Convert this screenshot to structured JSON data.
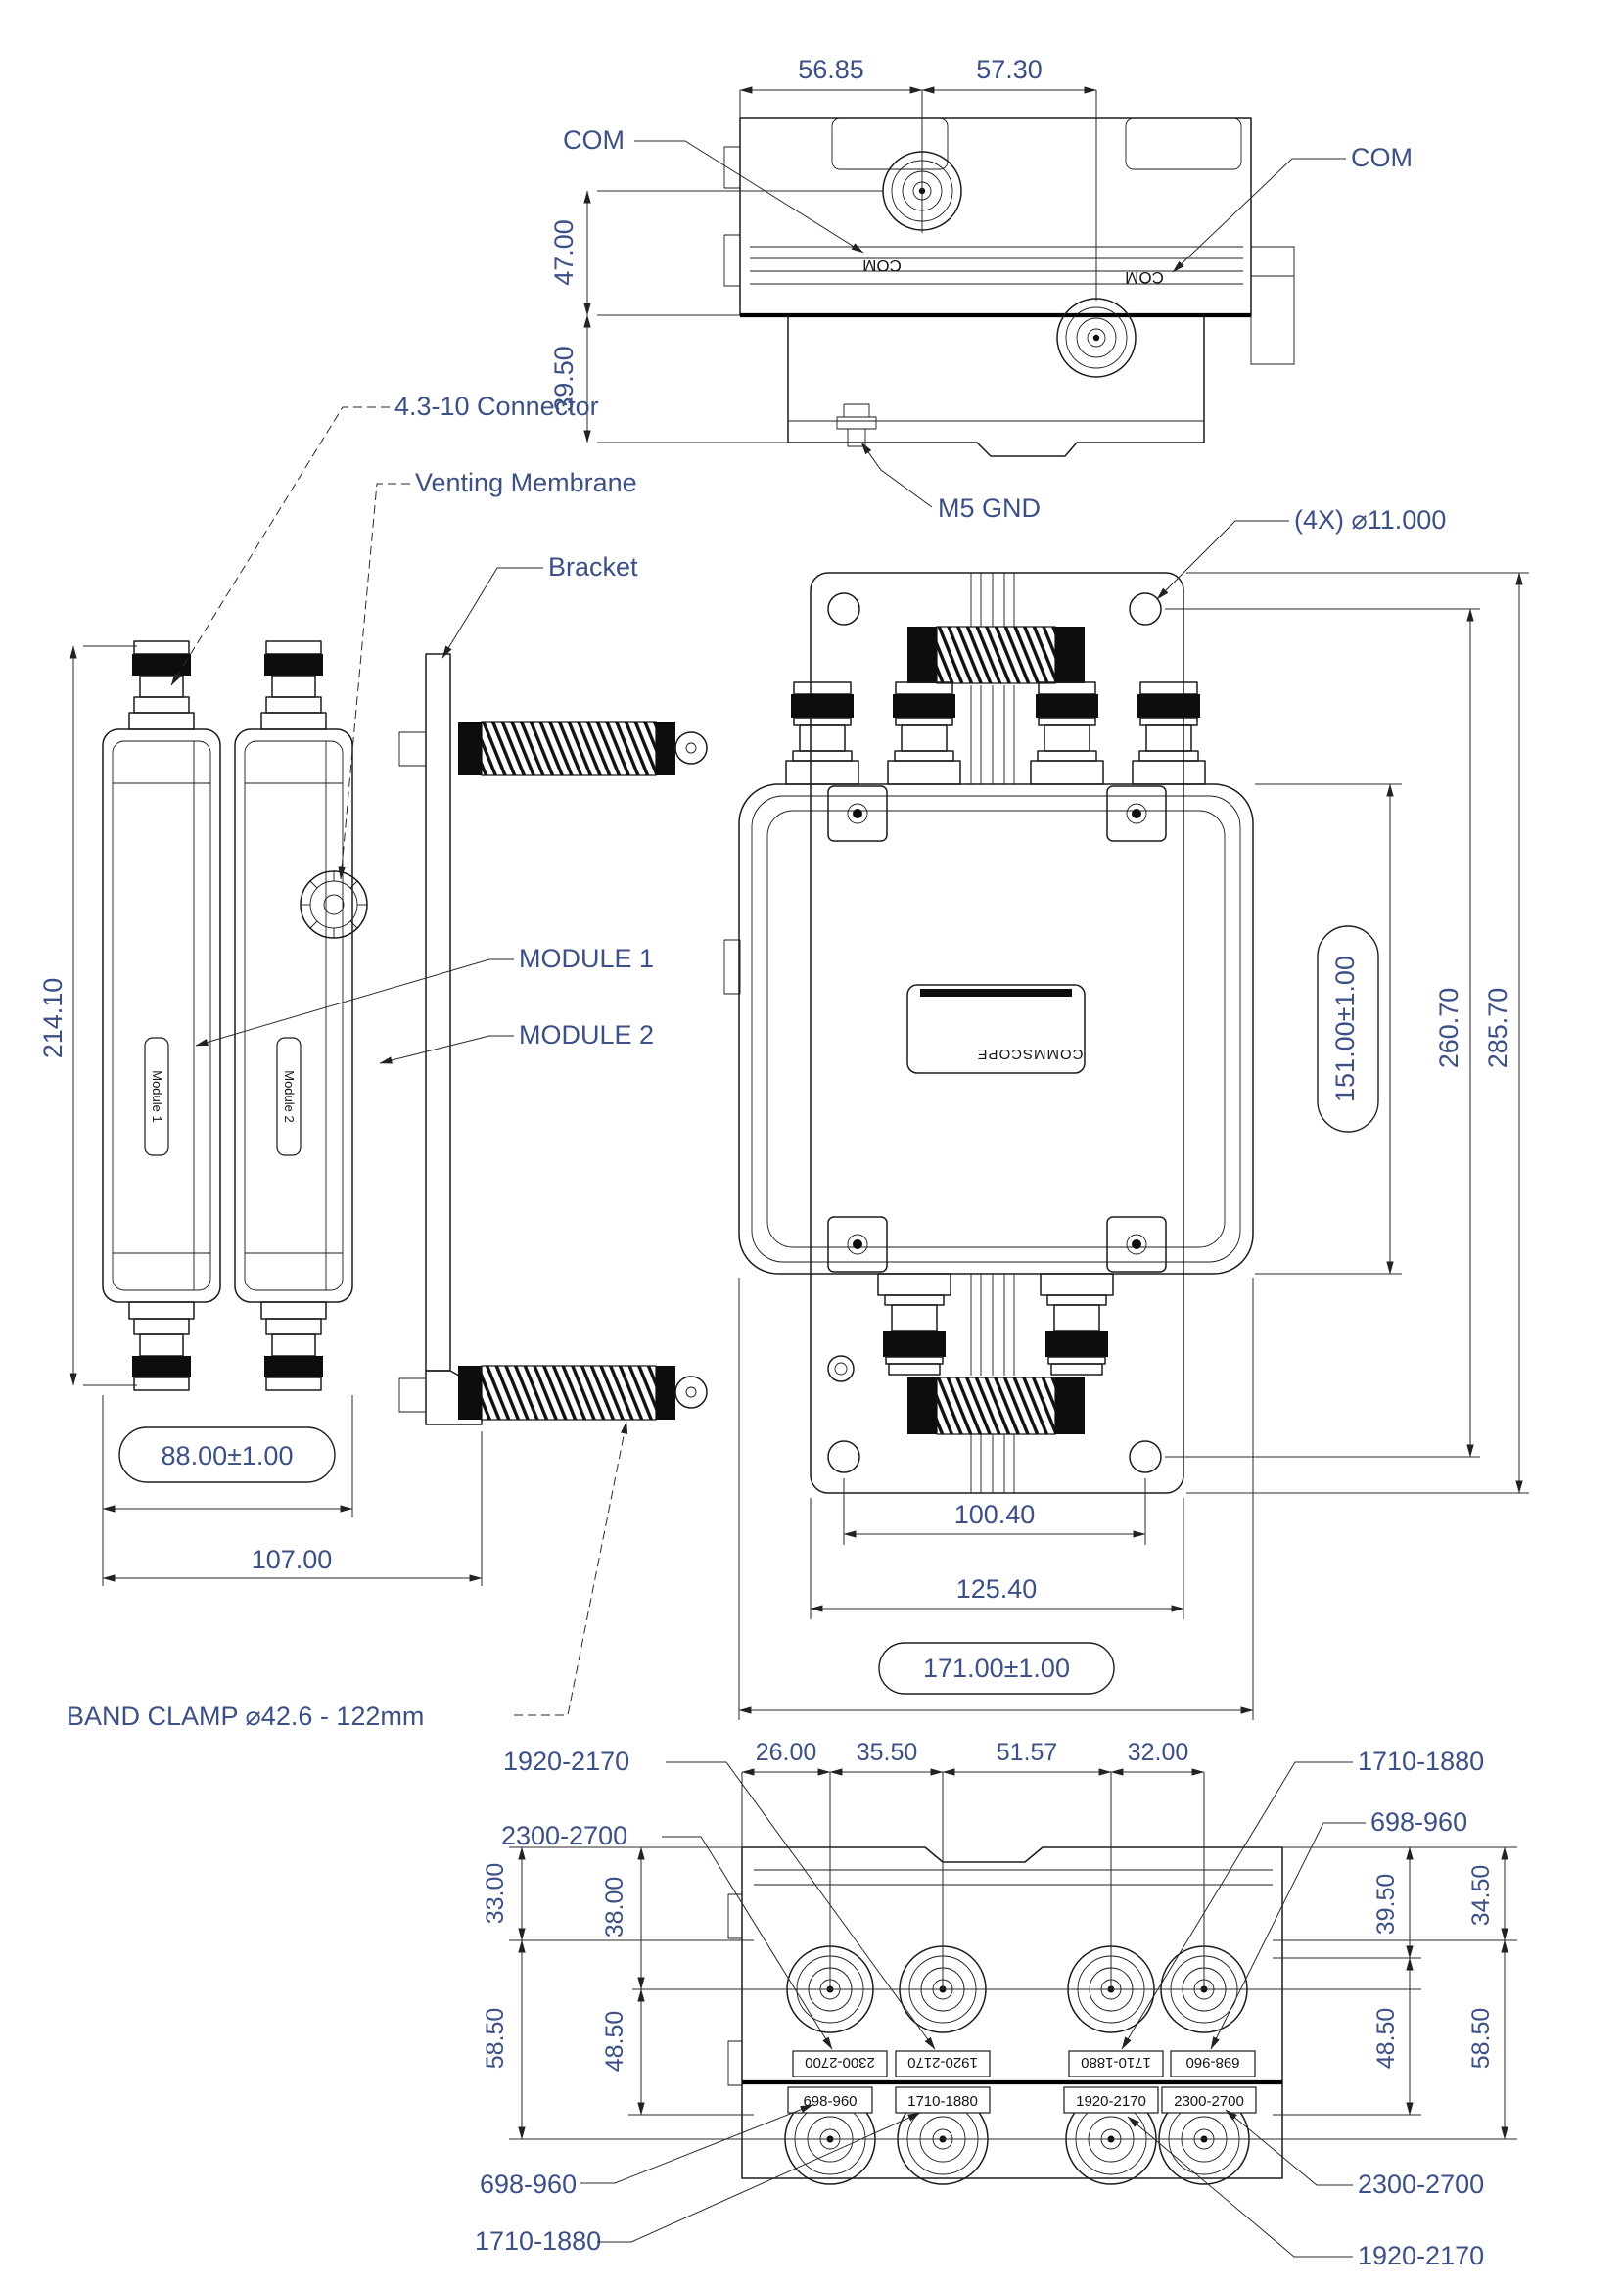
{
  "drawing": {
    "colors": {
      "background": "#ffffff",
      "line": "#1b1b1b",
      "dimension_text": "#3c5086"
    }
  },
  "views": {
    "top": {
      "dim_56_85": "56.85",
      "dim_57_30": "57.30",
      "dim_47_00": "47.00",
      "dim_39_50": "39.50",
      "callout_com_left": "COM",
      "callout_com_right": "COM",
      "callout_m5_gnd": "M5 GND",
      "marking_com_left": "COM",
      "marking_com_right": "COM"
    },
    "side": {
      "dim_214_10": "214.10",
      "dim_88_00": "88.00±1.00",
      "dim_107_00": "107.00",
      "callout_connector": "4.3-10 Connector",
      "callout_venting": "Venting Membrane",
      "callout_bracket": "Bracket",
      "callout_module1": "MODULE 1",
      "callout_module2": "MODULE 2",
      "callout_band_clamp": "BAND CLAMP ⌀42.6 - 122mm",
      "marking_module1": "Module 1",
      "marking_module2": "Module 2"
    },
    "front": {
      "callout_holes": "(4X) ⌀11.000",
      "dim_151_00": "151.00±1.00",
      "dim_260_70": "260.70",
      "dim_285_70": "285.70",
      "dim_100_40": "100.40",
      "dim_125_40": "125.40",
      "dim_171_00": "171.00±1.00",
      "marking_brand": "COMMSCOPE"
    },
    "bottom": {
      "dim_26_00": "26.00",
      "dim_35_50": "35.50",
      "dim_51_57": "51.57",
      "dim_32_00": "32.00",
      "dim_33_00": "33.00",
      "dim_38_00": "38.00",
      "dim_58_50_left": "58.50",
      "dim_48_50_left": "48.50",
      "dim_39_50": "39.50",
      "dim_34_50": "34.50",
      "dim_48_50_right": "48.50",
      "dim_58_50_right": "58.50",
      "callout_top_left_1": "1920-2170",
      "callout_top_left_2": "2300-2700",
      "callout_top_right_1": "1710-1880",
      "callout_top_right_2": "698-960",
      "callout_bottom_left_1": "698-960",
      "callout_bottom_left_2": "1710-1880",
      "callout_bottom_right_1": "2300-2700",
      "callout_bottom_right_2": "1920-2170",
      "port_labels_top": [
        "2300-2700",
        "1920-2170",
        "1710-1880",
        "698-960"
      ],
      "port_labels_bottom": [
        "698-960",
        "1710-1880",
        "1920-2170",
        "2300-2700"
      ]
    }
  }
}
